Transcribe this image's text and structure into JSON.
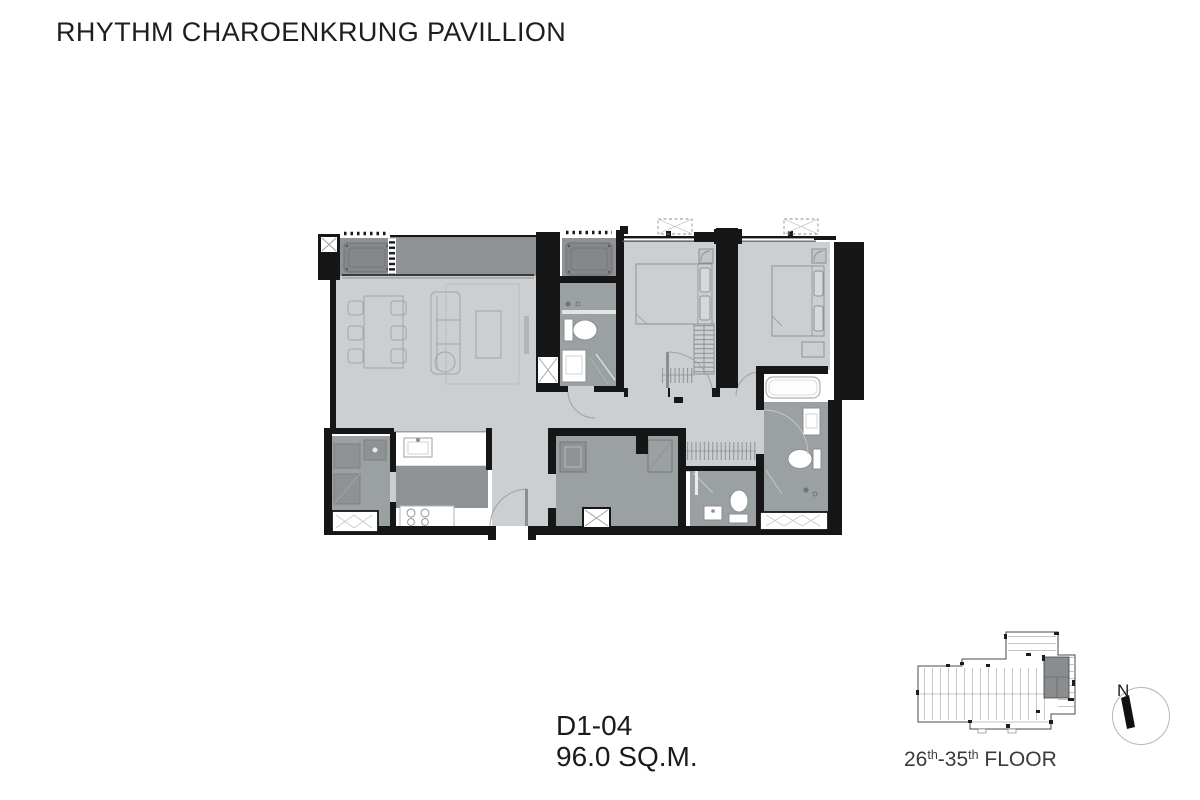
{
  "header": {
    "title": "RHYTHM CHAROENKRUNG PAVILLION"
  },
  "unit_label": {
    "code": "D1-04",
    "area": "96.0 SQ.M."
  },
  "key_plan": {
    "floor_range": {
      "num1": "26",
      "sup1": "th",
      "num2": "-35",
      "sup2": "th",
      "rest": " FLOOR"
    },
    "north": {
      "label": "N"
    },
    "unit_highlight_color": "#8a8d90"
  },
  "floor_plan": {
    "colors": {
      "wall": "#161616",
      "floor_light": "#cccfd1",
      "floor_mid": "#9ba0a3",
      "floor_dark": "#909396",
      "fixture_white": "#ffffff"
    }
  }
}
